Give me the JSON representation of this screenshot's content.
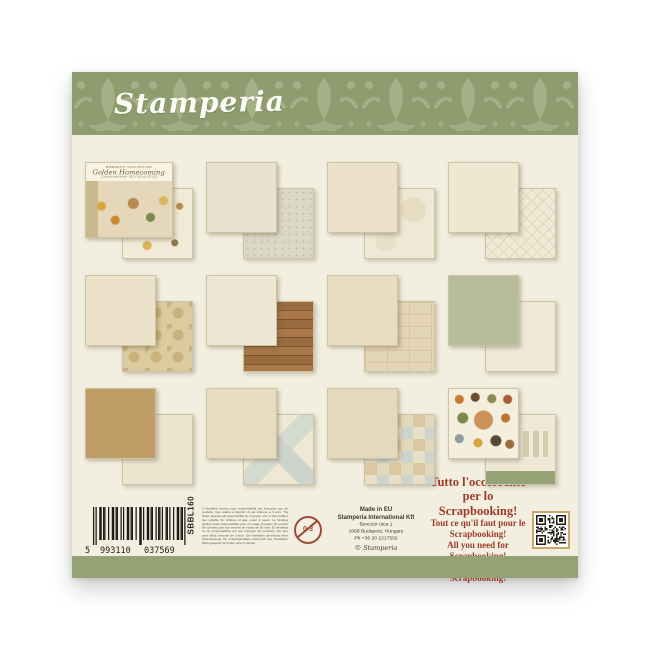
{
  "brand": {
    "logo_text": "Stamperia",
    "paw_marks": "❉❉"
  },
  "cover": {
    "collection_line": "ROMANTIC COLLECTION",
    "title_script": "Golden Homecoming",
    "subtitle": "12 double faced sheets · 30.5 × 30.5 cm (12\"×12\")"
  },
  "footer": {
    "barcode": {
      "prefix": "5",
      "group1": "993110",
      "group2": "037569",
      "sku": "SBBL160"
    },
    "warning_text": "Il Venditore declina ogni responsabilità per improprio uso del prodotto. Non adatto a bambini di età inferiore a 3 anni. The Seller declines all responsibility for improper use of this product. Not suitable for children of age under 3 years. Le Vendeur décline toute responsabilité pour un usage impropre du produit. Ne convient pas aux enfants de moins de 36 mois. El vendedor no se responsabiliza del uso impropio del producto. No apto para niños menores de 3 años. Der Verkäufer übernimmt keine Verantwortung für unsachgemäßen Gebrauch des Produktes. Nicht geeignet für Kinder unter 3 Jahren.",
    "age_icon_label": "0-3",
    "manufacturer": {
      "line1": "Made in EU",
      "line2": "Stamperia International Kft",
      "line3": "Benczúr utca 1",
      "line4": "1068 Budapest, Hungary",
      "line5": "Ph +36 20 2217502",
      "copyright": "© Stamperia"
    },
    "slogans": [
      "Tutto l'occorrente per lo Scrapbooking!",
      "Tout ce qu'il faut pour le Scrapbooking!",
      "All you need for Scrapbooking!",
      "Todo lo necesario por el Scrapbooking!"
    ]
  },
  "colors": {
    "banner_green": "#8e9c70",
    "banner_motif": "#a9b48b",
    "body_cream": "#f3efe0",
    "strip_green": "#95a276",
    "slogan_red": "#9b3a28",
    "qr_border": "#c9a66a"
  }
}
